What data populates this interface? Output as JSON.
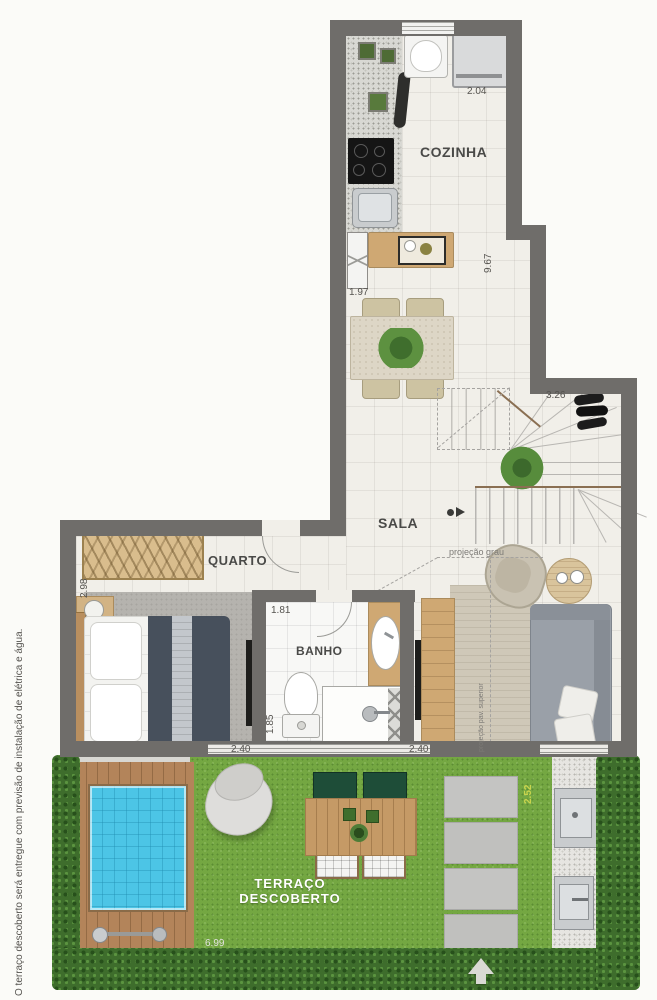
{
  "rooms": {
    "cozinha": "COZINHA",
    "sala": "SALA",
    "quarto": "QUARTO",
    "banho": "BANHO",
    "terraco_line1": "TERRAÇO",
    "terraco_line2": "DESCOBERTO"
  },
  "dimensions": {
    "kitchen_width": "2.04",
    "kitchen_length": "9.67",
    "counter_width": "1.97",
    "stairs_width": "3.26",
    "bedroom_depth": "2.98",
    "bath_width": "1.81",
    "bath_depth": "1.85",
    "bedroom_width": "2.40",
    "living_width": "2.40",
    "terrace_side": "2.52",
    "terrace_width": "6.99"
  },
  "annotations": {
    "projection_note": "projeção grau",
    "projection_note_vertical": "projeção pav. superior",
    "disclaimer": "O terraço descoberto será entregue com previsão de instalação de elétrica e água."
  },
  "colors": {
    "wall": "#6f6d6a",
    "floor": "#f1efe9",
    "grass": "#74a742",
    "hedge": "#3e6d2c",
    "pool": "#4cc5e6",
    "deck": "#b3845a",
    "dim_green": "#c9d44d",
    "label": "#4a4a48"
  }
}
